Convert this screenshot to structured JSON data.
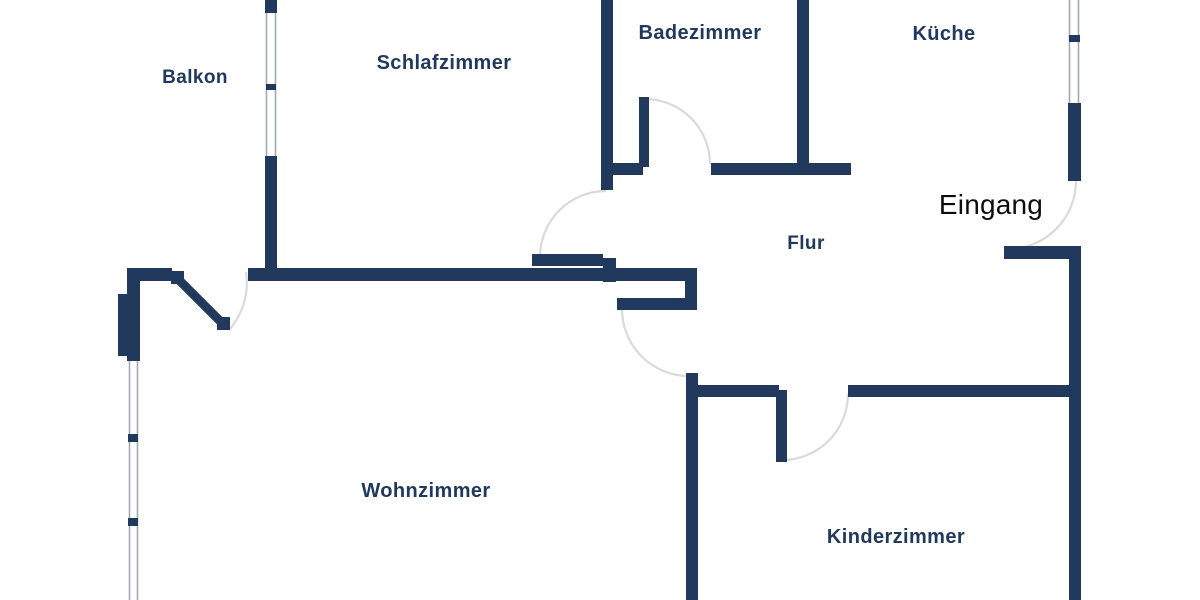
{
  "floorplan": {
    "canvas": {
      "width": 1200,
      "height": 600,
      "background": "#ffffff"
    },
    "colors": {
      "wall": "#20395c",
      "label": "#20395c",
      "entrance_label": "#0d0d0d",
      "arc": "#d9dadd",
      "window_line": "#a3a9b2"
    },
    "labels": [
      {
        "id": "balkon",
        "text": "Balkon",
        "x": 195,
        "y": 83,
        "size": 19,
        "style": "room"
      },
      {
        "id": "schlafzimmer",
        "text": "Schlafzimmer",
        "x": 444,
        "y": 69,
        "size": 20,
        "style": "room"
      },
      {
        "id": "badezimmer",
        "text": "Badezimmer",
        "x": 700,
        "y": 39,
        "size": 20,
        "style": "room"
      },
      {
        "id": "kueche",
        "text": "Küche",
        "x": 944,
        "y": 40,
        "size": 20,
        "style": "room"
      },
      {
        "id": "flur",
        "text": "Flur",
        "x": 806,
        "y": 249,
        "size": 19,
        "style": "room"
      },
      {
        "id": "eingang",
        "text": "Eingang",
        "x": 991,
        "y": 214,
        "size": 28,
        "style": "entrance"
      },
      {
        "id": "wohnzimmer",
        "text": "Wohnzimmer",
        "x": 426,
        "y": 497,
        "size": 20,
        "style": "room"
      },
      {
        "id": "kinderzimmer",
        "text": "Kinderzimmer",
        "x": 896,
        "y": 543,
        "size": 20,
        "style": "room"
      }
    ],
    "walls": [
      [
        127,
        268,
        45,
        13
      ],
      [
        248,
        268,
        449,
        13
      ],
      [
        601,
        0,
        12,
        190
      ],
      [
        127,
        268,
        13,
        30
      ],
      [
        118,
        294,
        22,
        62
      ],
      [
        613,
        163,
        30,
        12
      ],
      [
        711,
        163,
        140,
        12
      ],
      [
        797,
        0,
        12,
        175
      ],
      [
        1068,
        103,
        13,
        78
      ],
      [
        1069,
        246,
        12,
        354
      ],
      [
        685,
        268,
        12,
        42
      ],
      [
        686,
        373,
        12,
        227
      ],
      [
        698,
        385,
        81,
        12
      ],
      [
        848,
        385,
        233,
        12
      ],
      [
        265,
        0,
        12,
        13
      ],
      [
        265,
        156,
        12,
        112
      ],
      [
        127,
        354,
        13,
        7
      ],
      [
        128,
        434,
        10,
        8
      ],
      [
        128,
        518,
        10,
        8
      ],
      [
        266,
        84,
        10,
        6
      ],
      [
        1069,
        35,
        11,
        7
      ]
    ],
    "windows": [
      {
        "id": "balcony-window",
        "x1": 266.5,
        "y1": 13,
        "x2": 275.5,
        "y2": 156
      },
      {
        "id": "livingroom-window",
        "x1": 129.5,
        "y1": 357,
        "x2": 137.5,
        "y2": 600
      },
      {
        "id": "kitchen-window",
        "x1": 1069.5,
        "y1": 0,
        "x2": 1078.5,
        "y2": 103
      }
    ],
    "doors": [
      {
        "id": "balcony-door",
        "diagonal": {
          "x1": 177,
          "y1": 278,
          "x2": 223,
          "y2": 324,
          "w": 9
        },
        "caps": [
          [
            171,
            271,
            13,
            13
          ],
          [
            217,
            317,
            13,
            13
          ]
        ],
        "arc": "M 246 272 A 71 71 0 0 1 229 330"
      },
      {
        "id": "schlafzimmer-door",
        "leaves": [
          [
            532,
            254,
            71,
            12
          ],
          [
            603,
            258,
            13,
            24
          ]
        ],
        "arc": "M 606 191 A 66 66 0 0 0 540 257"
      },
      {
        "id": "badezimmer-door",
        "leaves": [
          [
            639,
            97,
            10,
            70
          ]
        ],
        "arc": "M 645 99 A 65 65 0 0 1 710 164"
      },
      {
        "id": "wohnzimmer-door",
        "leaves": [
          [
            617,
            298,
            68,
            12
          ]
        ],
        "arc": "M 622 309 A 67 67 0 0 0 689 376"
      },
      {
        "id": "kinderzimmer-door",
        "leaves": [
          [
            776,
            390,
            11,
            72
          ]
        ],
        "arc": "M 848 394 A 66 66 0 0 1 782 460"
      },
      {
        "id": "entrance-door",
        "leaves": [
          [
            1004,
            246,
            77,
            13
          ]
        ],
        "arc": "M 1008 249 A 68 68 0 0 0 1076 181"
      }
    ]
  }
}
